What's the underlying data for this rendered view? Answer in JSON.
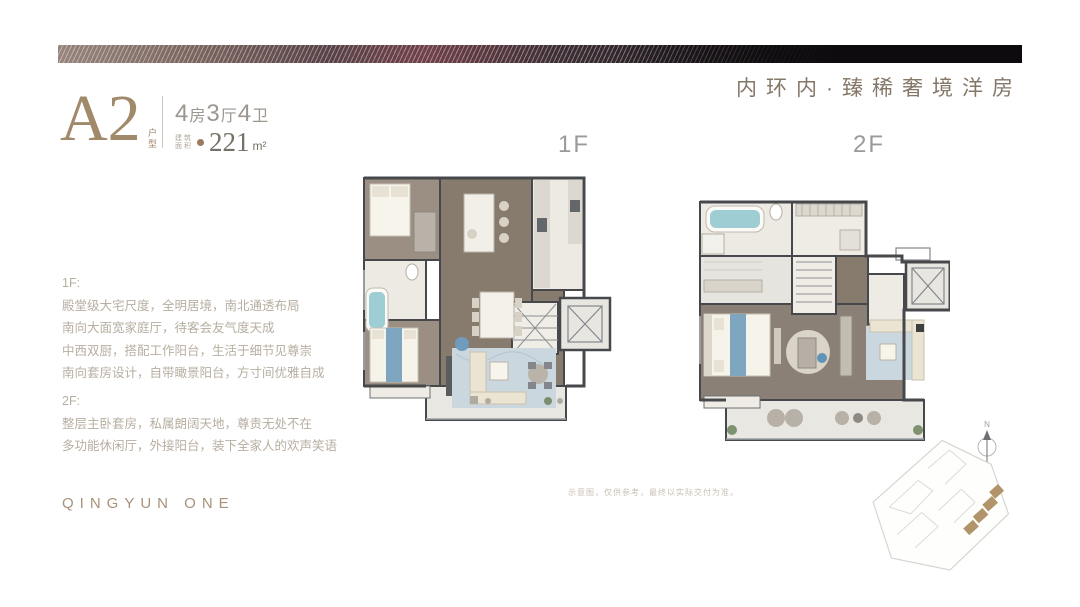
{
  "header": {
    "slogan": "内环内·臻稀奢境洋房"
  },
  "unit": {
    "name": "A2",
    "category": "户型",
    "layout": [
      {
        "num": "4",
        "unit": "房"
      },
      {
        "num": "3",
        "unit": "厅"
      },
      {
        "num": "4",
        "unit": "卫"
      }
    ],
    "area_label": [
      "建筑",
      "面积"
    ],
    "area_value": "221",
    "area_unit": "m²"
  },
  "floors": {
    "f1": {
      "label": "1F",
      "heading": "1F:",
      "lines": [
        "殿堂级大宅尺度，全明居境，南北通透布局",
        "南向大面宽家庭厅，待客会友气度天成",
        "中西双厨，搭配工作阳台，生活于细节见尊崇",
        "南向套房设计，自带瞰景阳台，方寸间优雅自成"
      ]
    },
    "f2": {
      "label": "2F",
      "heading": "2F:",
      "lines": [
        "整层主卧套房，私属朗阔天地，尊贵无处不在",
        "多功能休闲厅，外接阳台，装下全家人的欢声笑语"
      ]
    }
  },
  "footer": {
    "brand": "QINGYUN ONE",
    "disclaimer": "示意图，仅供参考，最终以实际交付为准。"
  },
  "compass": {
    "north_label": "N"
  },
  "colors": {
    "bronze": "#a18a6a",
    "taupe": "#847767",
    "spec-text": "#9c968f",
    "area-num": "#767069",
    "body-text": "#b7aea1",
    "floor-label": "#9a9a9a",
    "brand": "#a8927a",
    "disclaimer": "#c9c0b3",
    "wall": "#46484b",
    "wood": "#8b8076",
    "wood-light": "#9a8f82",
    "room": "#efece5",
    "rug": "#c9d6de",
    "cream": "#ece4d2",
    "teal": "#9fcdd4",
    "blue": "#7fa6c0",
    "site-bronze": "#b2946b"
  }
}
